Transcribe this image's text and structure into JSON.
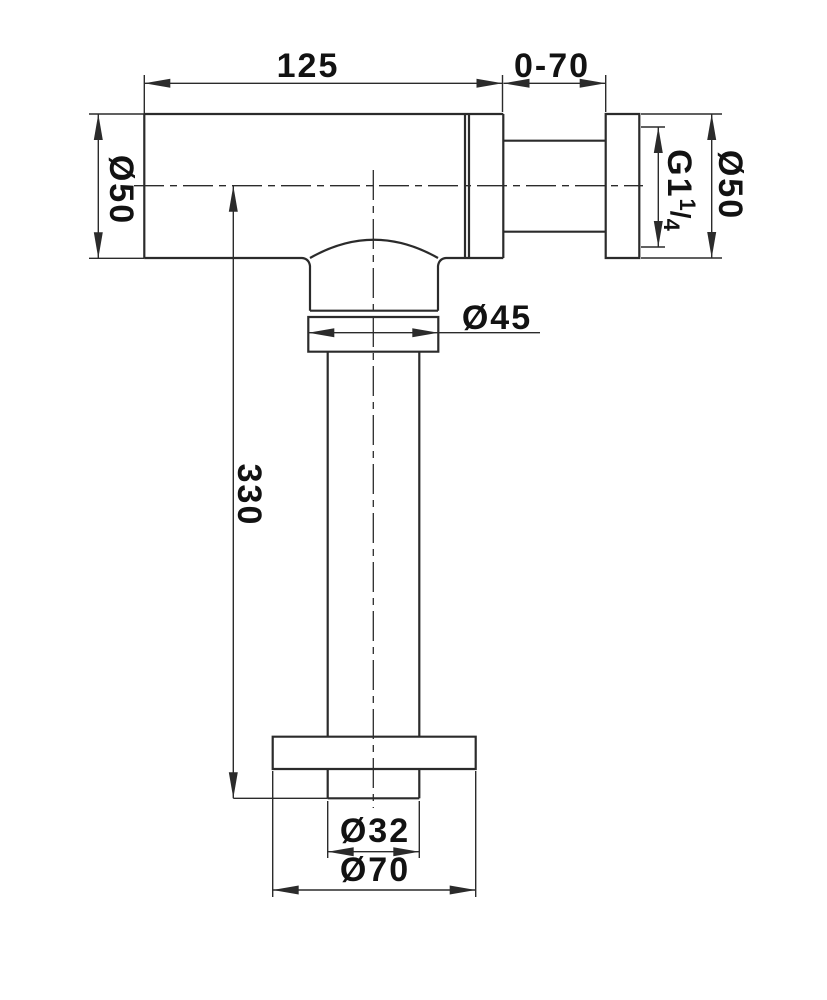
{
  "drawing": {
    "name": "bottle-trap-technical-drawing",
    "colors": {
      "line": "#2b2b2b",
      "text": "#121212",
      "background": "#ffffff"
    },
    "labels": {
      "body_length": "125",
      "adjust_range": "0-70",
      "inlet_diameter": "Ø50",
      "outlet_diameter": "Ø50",
      "thread_prefix": "G1",
      "thread_frac_num": "1",
      "thread_frac_slash": "/",
      "thread_frac_den": "4",
      "cup_nut_diameter": "Ø45",
      "tailpipe_length": "330",
      "tailpipe_diameter": "Ø32",
      "flange_diameter": "Ø70"
    }
  }
}
